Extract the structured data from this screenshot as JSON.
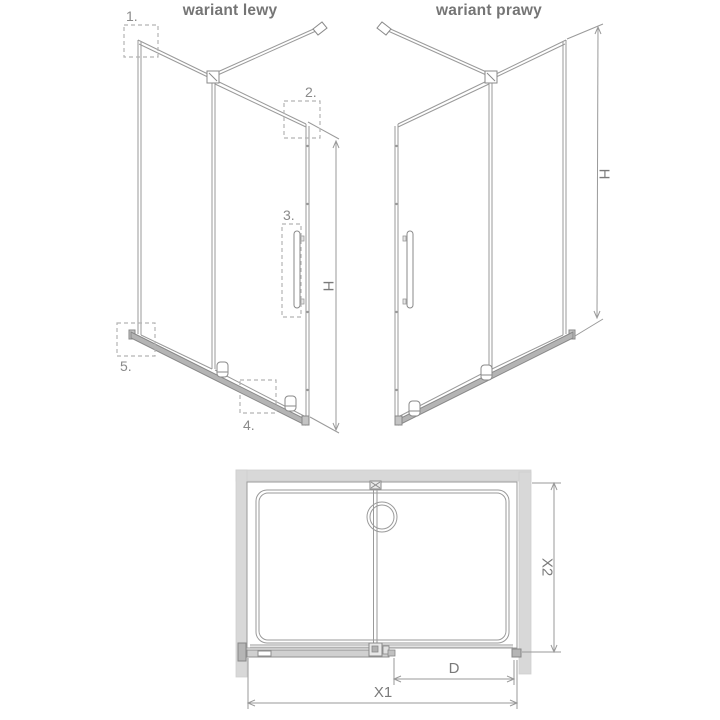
{
  "diagram": {
    "type": "technical-drawing-shower-walkin",
    "left_variant": {
      "title": "wariant lewy",
      "height_label": "H"
    },
    "right_variant": {
      "title": "wariant prawy",
      "height_label": "H"
    },
    "callout_labels": [
      "1.",
      "2.",
      "3.",
      "4.",
      "5."
    ],
    "plan_view": {
      "total_width_label": "X1",
      "depth_label": "X2",
      "door_width_label": "D"
    },
    "colors": {
      "line": "#9a9a9a",
      "dark_line": "#888888",
      "wall_fill": "#d8d8d8",
      "rail_fill": "#b4b4b4",
      "profile_fill": "#b5b5b5",
      "door_band_fill": "#d0d0d0",
      "callout_dash": "#b3b3b3",
      "label_text": "#8a8a8a",
      "title_text": "#757575",
      "background": "#ffffff"
    }
  }
}
